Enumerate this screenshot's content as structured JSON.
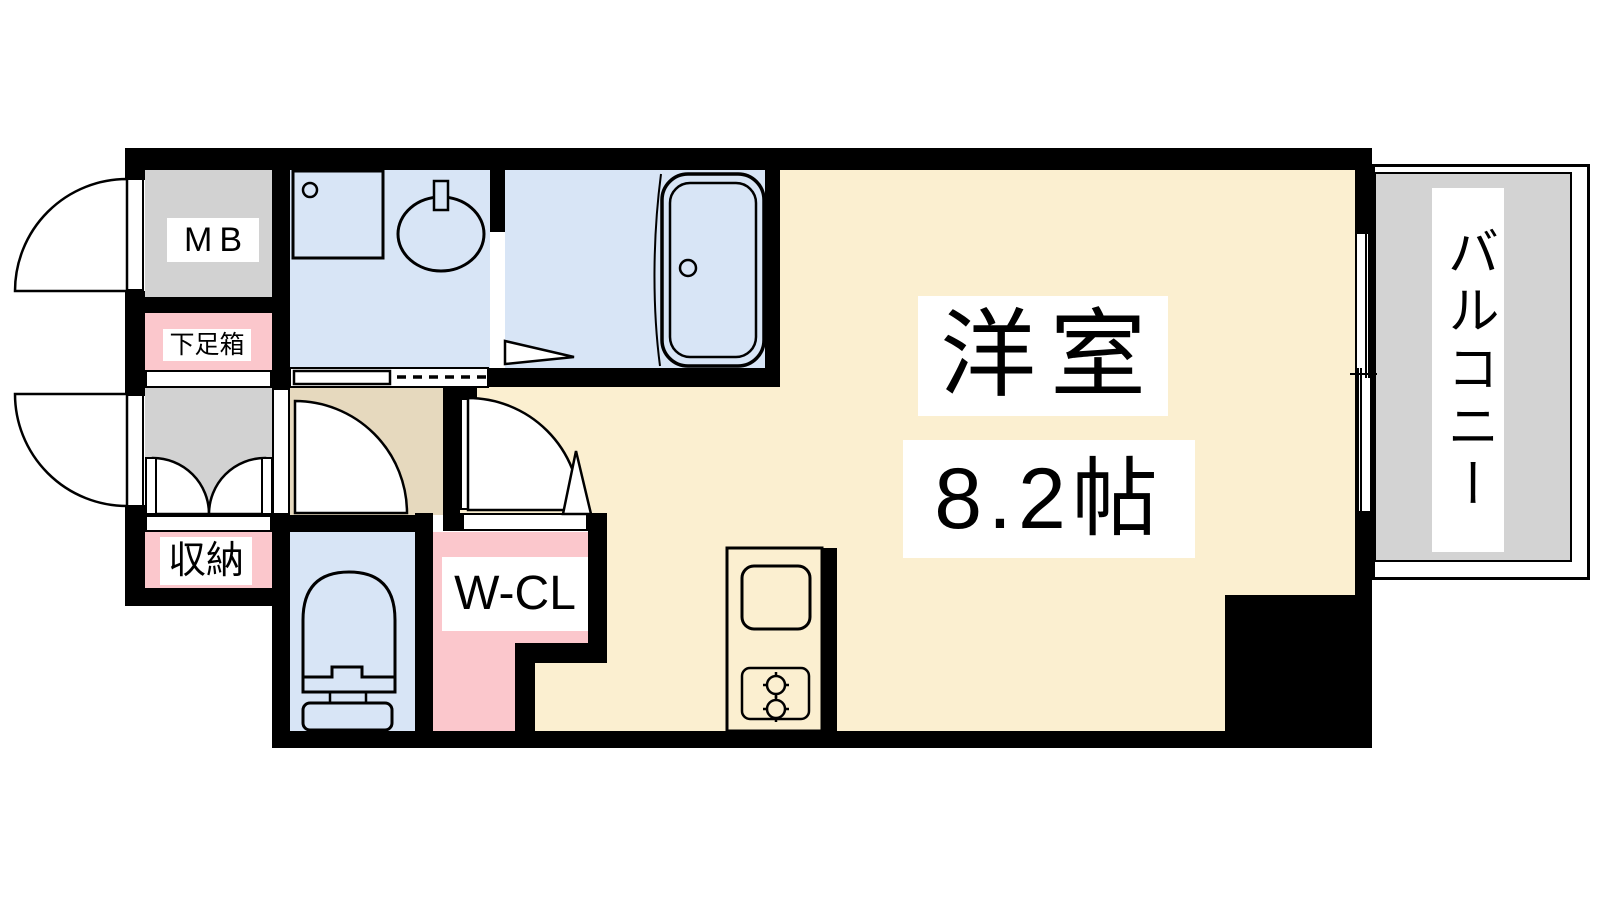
{
  "plan": {
    "type": "apartment-floor-plan",
    "labels": {
      "meter_box": "MB",
      "shoe_box": "下足箱",
      "storage": "収納",
      "walk_in_closet": "W-CL",
      "main_room_name": "洋室",
      "main_room_size": "8.2帖",
      "balcony": "バルコニー"
    },
    "colors": {
      "wall": "#000000",
      "line": "#000000",
      "background": "#FFFFFF",
      "floor_cream": "#FBEFD0",
      "wet_area_blue": "#D8E5F6",
      "closet_pink": "#FBC7CC",
      "utility_gray": "#D2D2D2",
      "hall_tan": "#E6D9BE",
      "balcony_gray": "#D3D3D3"
    },
    "icons": {
      "fixtures": [
        "washing-machine-pan-icon",
        "washbasin-icon",
        "bathtub-icon",
        "toilet-icon",
        "kitchen-sink-icon",
        "stove-burner-icon"
      ],
      "symbols": [
        "door-swing-arc",
        "double-door-swing-arc",
        "sliding-door-dashed-track",
        "door-direction-triangle",
        "sliding-window"
      ]
    }
  }
}
